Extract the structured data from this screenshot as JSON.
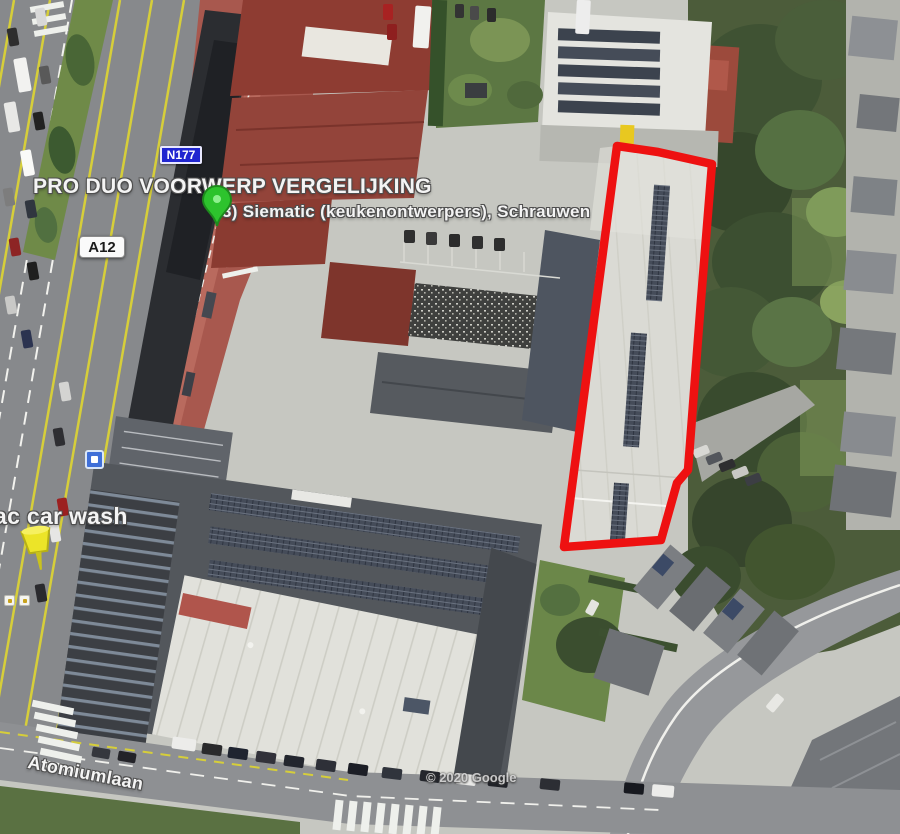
{
  "map": {
    "annotation_title": "PRO DUO VOORWERP VERGELIJKING",
    "poi_label": "3) Siematic (keukenontwerpers), Schrauwen",
    "car_wash_label": "ac car wash",
    "street_label": "Atomiumlaan",
    "attribution": "© 2020 Google",
    "road_badges": {
      "n177": "N177",
      "a12": "A12"
    },
    "icons": {
      "green_pin": "green-placemark-pin",
      "yellow_pin": "yellow-pushpin-marker",
      "transit": "transit-stop-icon"
    },
    "colors": {
      "highlight_red": "#ee1111",
      "n177_blue": "#2126d0",
      "a12_white": "#fafafa",
      "pin_green": "#2dc32d",
      "pin_green_dark": "#1d8a1d",
      "pin_yellow": "#ece428",
      "pin_yellow_dark": "#b7b014",
      "transit_blue": "#3f6fd8"
    }
  }
}
